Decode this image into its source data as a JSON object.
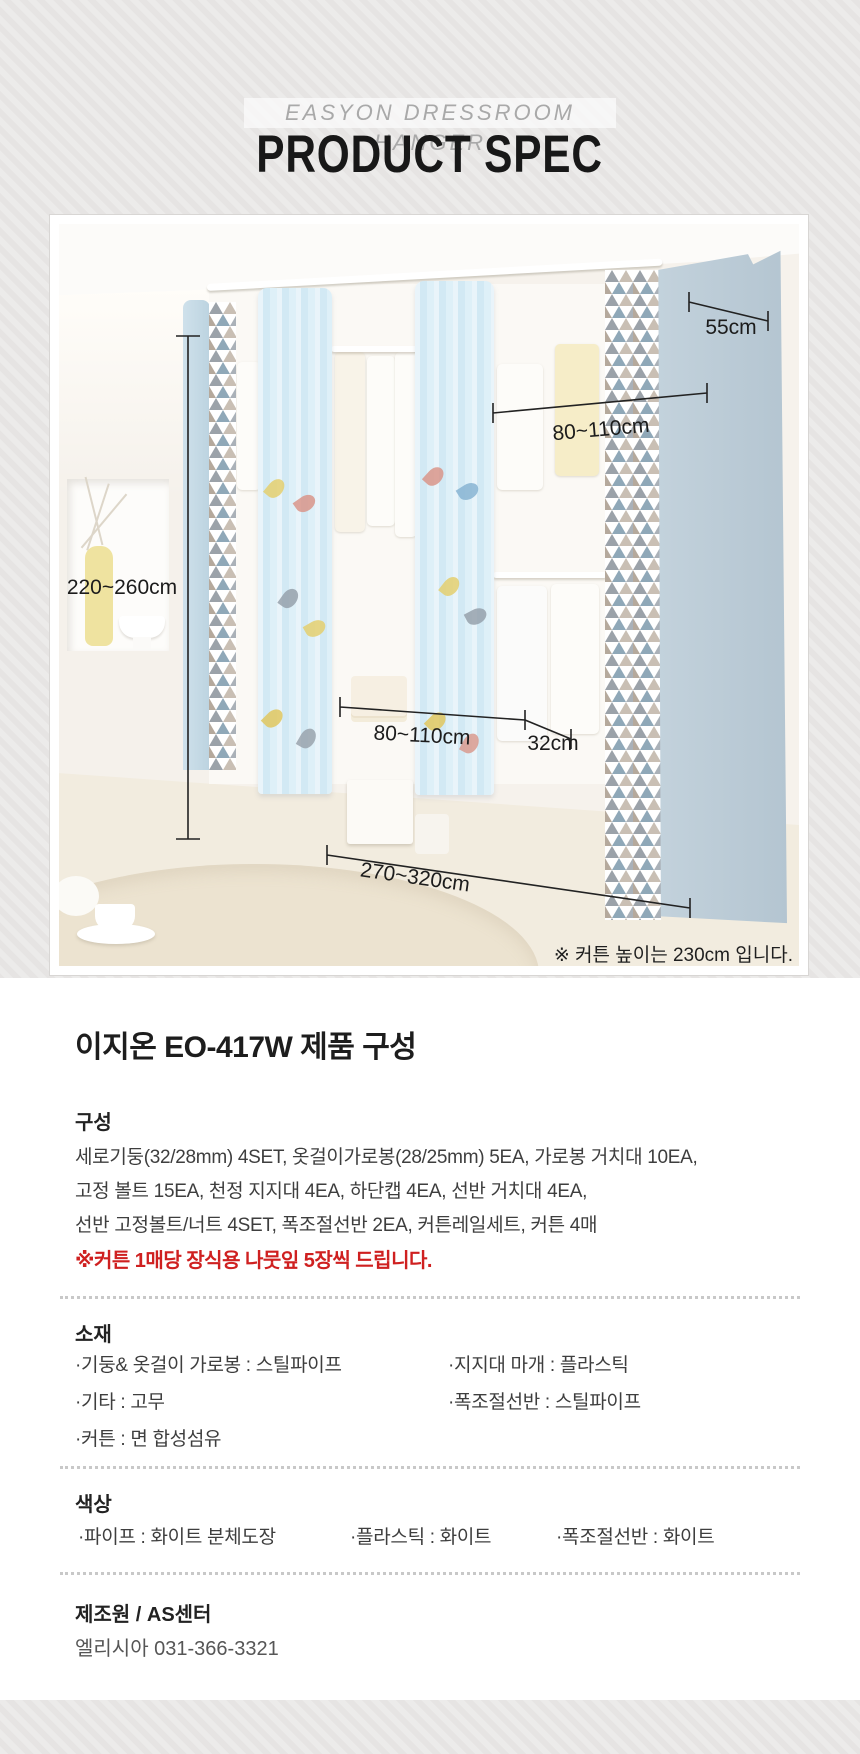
{
  "header": {
    "subtitle": "EASYON DRESSROOM HANGER",
    "title": "PRODUCT SPEC"
  },
  "product_image": {
    "dimensions": {
      "top_depth": "55cm",
      "upper_width": "80~110cm",
      "height": "220~260cm",
      "middle_width": "80~110cm",
      "shelf_depth": "32cm",
      "total_width": "270~320cm"
    },
    "note": "※ 커튼 높이는 230cm 입니다."
  },
  "spec": {
    "title": "이지온 EO-417W 제품 구성",
    "composition": {
      "label": "구성",
      "lines": [
        "세로기둥(32/28mm) 4SET, 옷걸이가로봉(28/25mm) 5EA, 가로봉 거치대 10EA,",
        "고정 볼트 15EA, 천정 지지대 4EA, 하단캡 4EA, 선반 거치대 4EA,",
        "선반 고정볼트/너트 4SET, 폭조절선반 2EA, 커튼레일세트, 커튼 4매"
      ],
      "notice": "※커튼 1매당 장식용 나뭇잎 5장씩 드립니다."
    },
    "material": {
      "label": "소재",
      "left_items": [
        "·기둥& 옷걸이 가로봉 : 스틸파이프",
        "·기타 : 고무",
        "·커튼 : 면 합성섬유"
      ],
      "right_items": [
        "·지지대 마개 : 플라스틱",
        "·폭조절선반 : 스틸파이프"
      ]
    },
    "color": {
      "label": "색상",
      "items": [
        "·파이프 : 화이트 분체도장",
        "·플라스틱 : 화이트",
        "·폭조절선반 : 화이트"
      ]
    },
    "manufacturer": {
      "label": "제조원 / AS센터",
      "value": "엘리시아 031-366-3321"
    }
  },
  "colors": {
    "accent_red": "#cf2020",
    "curtain_blue": "#d8ecf6",
    "panel_blue": "#bfcfd9",
    "stripe_background": "#e9e7e6"
  }
}
